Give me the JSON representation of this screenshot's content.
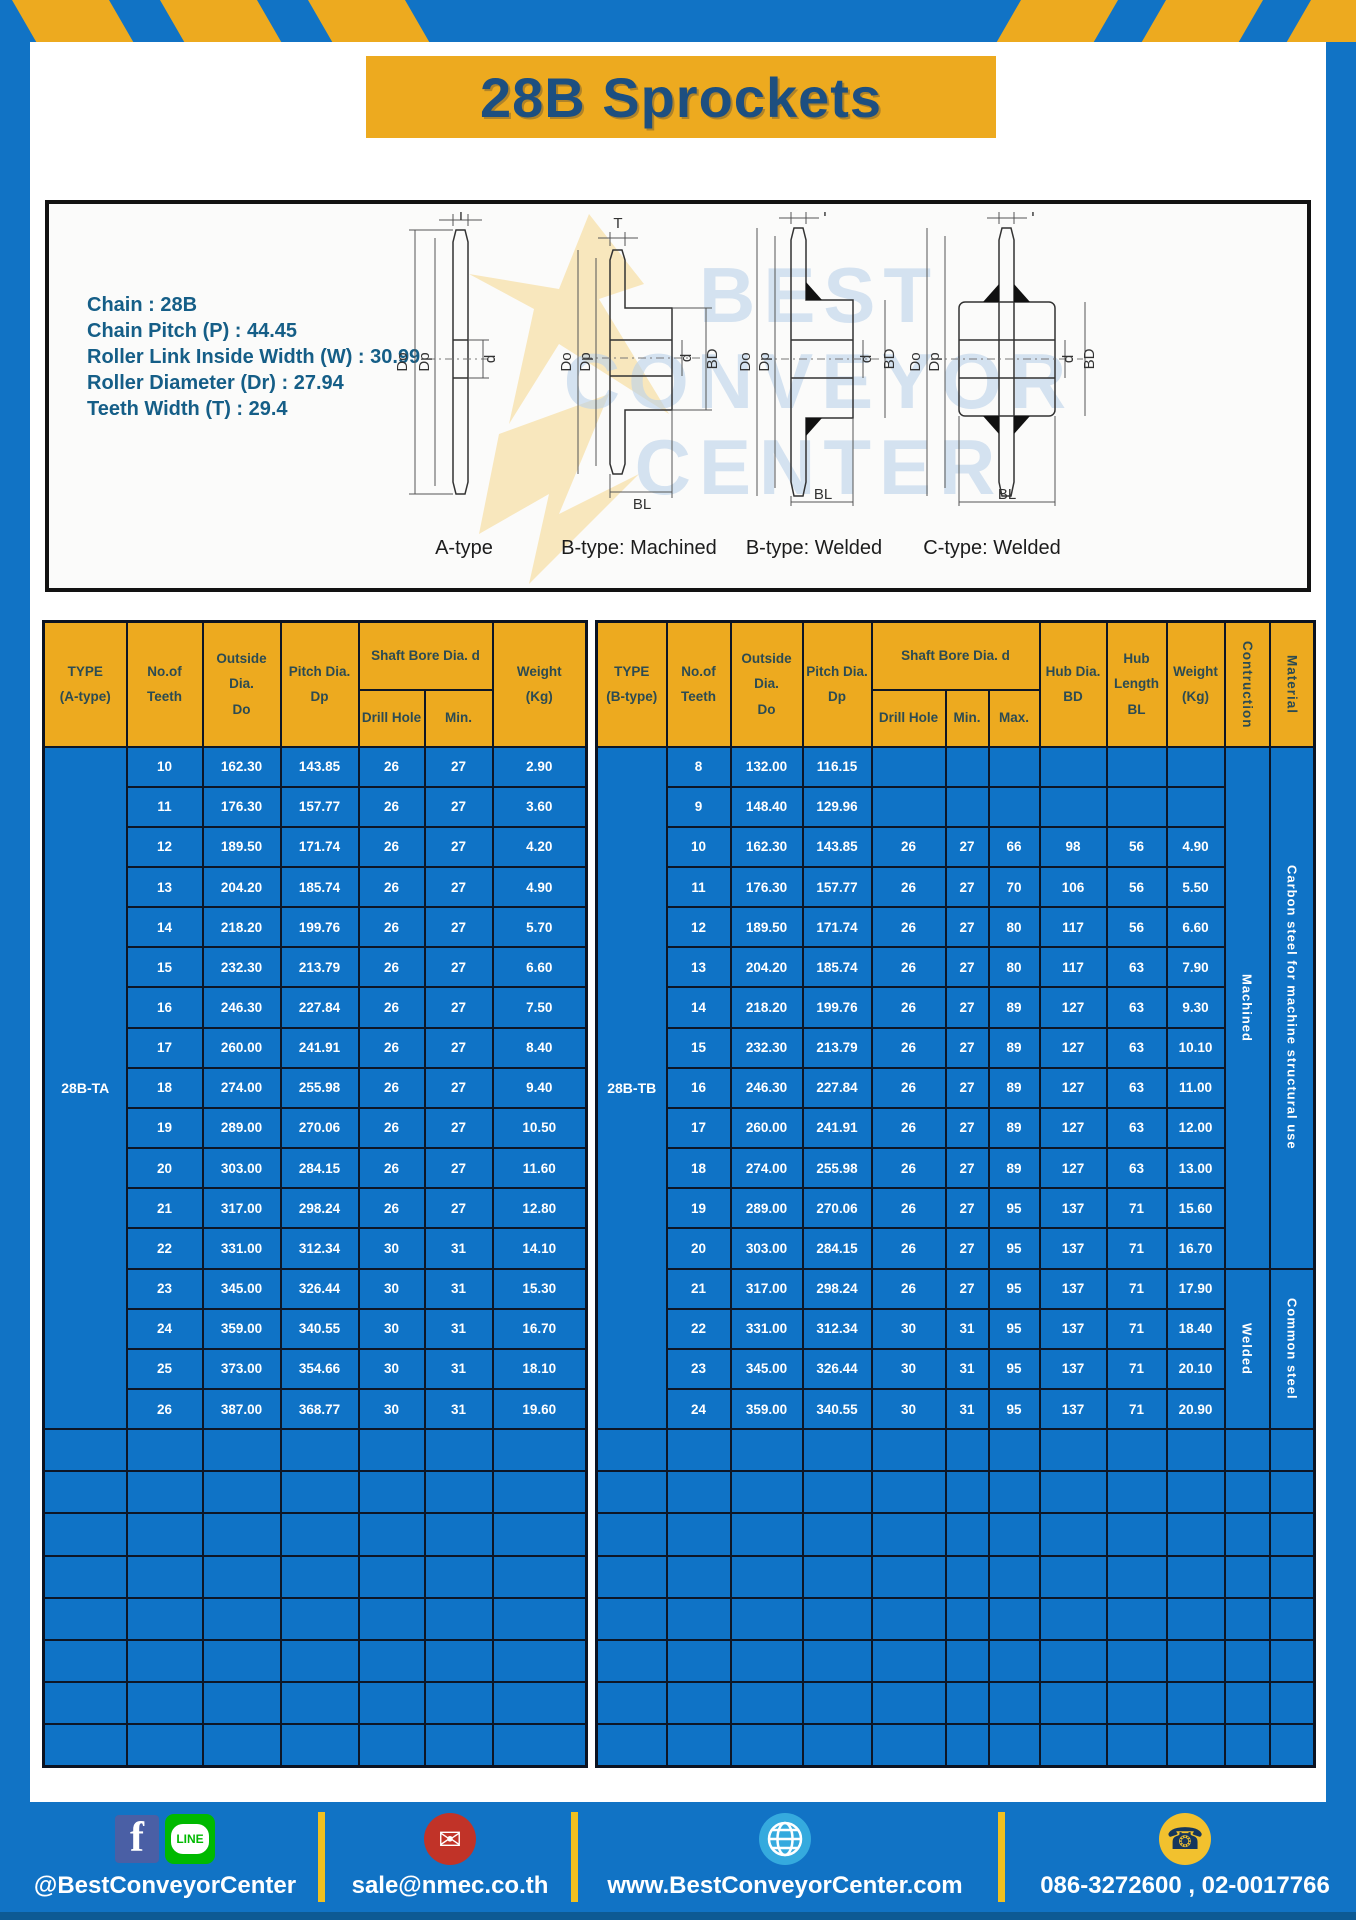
{
  "header": {
    "title": "28B Sprockets"
  },
  "specs": [
    "Chain  : 28B",
    "Chain Pitch (P)  : 44.45",
    "Roller Link Inside Width (W)  : 30.99",
    "Roller Diameter (Dr)  : 27.94",
    "Teeth Width (T)  : 29.4"
  ],
  "watermark": {
    "lines": [
      "BEST",
      "CONVEYOR",
      "CENTER"
    ]
  },
  "dims": {
    "t": "T",
    "doo": "Do",
    "dp": "Dp",
    "d": "d",
    "bd": "BD",
    "bl": "BL"
  },
  "diagrams": [
    {
      "caption": "A-type"
    },
    {
      "caption": "B-type: Machined"
    },
    {
      "caption": "B-type: Welded"
    },
    {
      "caption": "C-type: Welded"
    }
  ],
  "tableA": {
    "type": "28B-TA",
    "header": {
      "type": "TYPE\n(A-type)",
      "teeth": "No.of\nTeeth",
      "outside": "Outside\nDia.\nDo",
      "pitch": "Pitch Dia.\nDp",
      "shaft": "Shaft Bore Dia. d",
      "drill": "Drill Hole",
      "min": "Min.",
      "weight": "Weight\n(Kg)"
    },
    "rows": [
      {
        "teeth": "10",
        "do": "162.30",
        "dp": "143.85",
        "drill": "26",
        "min": "27",
        "weight": "2.90"
      },
      {
        "teeth": "11",
        "do": "176.30",
        "dp": "157.77",
        "drill": "26",
        "min": "27",
        "weight": "3.60"
      },
      {
        "teeth": "12",
        "do": "189.50",
        "dp": "171.74",
        "drill": "26",
        "min": "27",
        "weight": "4.20"
      },
      {
        "teeth": "13",
        "do": "204.20",
        "dp": "185.74",
        "drill": "26",
        "min": "27",
        "weight": "4.90"
      },
      {
        "teeth": "14",
        "do": "218.20",
        "dp": "199.76",
        "drill": "26",
        "min": "27",
        "weight": "5.70"
      },
      {
        "teeth": "15",
        "do": "232.30",
        "dp": "213.79",
        "drill": "26",
        "min": "27",
        "weight": "6.60"
      },
      {
        "teeth": "16",
        "do": "246.30",
        "dp": "227.84",
        "drill": "26",
        "min": "27",
        "weight": "7.50"
      },
      {
        "teeth": "17",
        "do": "260.00",
        "dp": "241.91",
        "drill": "26",
        "min": "27",
        "weight": "8.40"
      },
      {
        "teeth": "18",
        "do": "274.00",
        "dp": "255.98",
        "drill": "26",
        "min": "27",
        "weight": "9.40"
      },
      {
        "teeth": "19",
        "do": "289.00",
        "dp": "270.06",
        "drill": "26",
        "min": "27",
        "weight": "10.50"
      },
      {
        "teeth": "20",
        "do": "303.00",
        "dp": "284.15",
        "drill": "26",
        "min": "27",
        "weight": "11.60"
      },
      {
        "teeth": "21",
        "do": "317.00",
        "dp": "298.24",
        "drill": "26",
        "min": "27",
        "weight": "12.80"
      },
      {
        "teeth": "22",
        "do": "331.00",
        "dp": "312.34",
        "drill": "30",
        "min": "31",
        "weight": "14.10"
      },
      {
        "teeth": "23",
        "do": "345.00",
        "dp": "326.44",
        "drill": "30",
        "min": "31",
        "weight": "15.30"
      },
      {
        "teeth": "24",
        "do": "359.00",
        "dp": "340.55",
        "drill": "30",
        "min": "31",
        "weight": "16.70"
      },
      {
        "teeth": "25",
        "do": "373.00",
        "dp": "354.66",
        "drill": "30",
        "min": "31",
        "weight": "18.10"
      },
      {
        "teeth": "26",
        "do": "387.00",
        "dp": "368.77",
        "drill": "30",
        "min": "31",
        "weight": "19.60"
      }
    ]
  },
  "tableB": {
    "type": "28B-TB",
    "header": {
      "type": "TYPE\n(B-type)",
      "teeth": "No.of\nTeeth",
      "outside": "Outside\nDia.\nDo",
      "pitch": "Pitch Dia.\nDp",
      "shaft": "Shaft Bore Dia. d",
      "drill": "Drill Hole",
      "min": "Min.",
      "max": "Max.",
      "hubdia": "Hub Dia.\nBD",
      "hublen": "Hub\nLength\nBL",
      "weight": "Weight\n(Kg)",
      "construction": "Contruction",
      "material": "Material"
    },
    "rows": [
      {
        "teeth": "8",
        "do": "132.00",
        "dp": "116.15",
        "drill": "",
        "min": "",
        "max": "",
        "bd": "",
        "bl": "",
        "weight": ""
      },
      {
        "teeth": "9",
        "do": "148.40",
        "dp": "129.96",
        "drill": "",
        "min": "",
        "max": "",
        "bd": "",
        "bl": "",
        "weight": ""
      },
      {
        "teeth": "10",
        "do": "162.30",
        "dp": "143.85",
        "drill": "26",
        "min": "27",
        "max": "66",
        "bd": "98",
        "bl": "56",
        "weight": "4.90"
      },
      {
        "teeth": "11",
        "do": "176.30",
        "dp": "157.77",
        "drill": "26",
        "min": "27",
        "max": "70",
        "bd": "106",
        "bl": "56",
        "weight": "5.50"
      },
      {
        "teeth": "12",
        "do": "189.50",
        "dp": "171.74",
        "drill": "26",
        "min": "27",
        "max": "80",
        "bd": "117",
        "bl": "56",
        "weight": "6.60"
      },
      {
        "teeth": "13",
        "do": "204.20",
        "dp": "185.74",
        "drill": "26",
        "min": "27",
        "max": "80",
        "bd": "117",
        "bl": "63",
        "weight": "7.90"
      },
      {
        "teeth": "14",
        "do": "218.20",
        "dp": "199.76",
        "drill": "26",
        "min": "27",
        "max": "89",
        "bd": "127",
        "bl": "63",
        "weight": "9.30"
      },
      {
        "teeth": "15",
        "do": "232.30",
        "dp": "213.79",
        "drill": "26",
        "min": "27",
        "max": "89",
        "bd": "127",
        "bl": "63",
        "weight": "10.10"
      },
      {
        "teeth": "16",
        "do": "246.30",
        "dp": "227.84",
        "drill": "26",
        "min": "27",
        "max": "89",
        "bd": "127",
        "bl": "63",
        "weight": "11.00"
      },
      {
        "teeth": "17",
        "do": "260.00",
        "dp": "241.91",
        "drill": "26",
        "min": "27",
        "max": "89",
        "bd": "127",
        "bl": "63",
        "weight": "12.00"
      },
      {
        "teeth": "18",
        "do": "274.00",
        "dp": "255.98",
        "drill": "26",
        "min": "27",
        "max": "89",
        "bd": "127",
        "bl": "63",
        "weight": "13.00"
      },
      {
        "teeth": "19",
        "do": "289.00",
        "dp": "270.06",
        "drill": "26",
        "min": "27",
        "max": "95",
        "bd": "137",
        "bl": "71",
        "weight": "15.60"
      },
      {
        "teeth": "20",
        "do": "303.00",
        "dp": "284.15",
        "drill": "26",
        "min": "27",
        "max": "95",
        "bd": "137",
        "bl": "71",
        "weight": "16.70"
      },
      {
        "teeth": "21",
        "do": "317.00",
        "dp": "298.24",
        "drill": "26",
        "min": "27",
        "max": "95",
        "bd": "137",
        "bl": "71",
        "weight": "17.90"
      },
      {
        "teeth": "22",
        "do": "331.00",
        "dp": "312.34",
        "drill": "30",
        "min": "31",
        "max": "95",
        "bd": "137",
        "bl": "71",
        "weight": "18.40"
      },
      {
        "teeth": "23",
        "do": "345.00",
        "dp": "326.44",
        "drill": "30",
        "min": "31",
        "max": "95",
        "bd": "137",
        "bl": "71",
        "weight": "20.10"
      },
      {
        "teeth": "24",
        "do": "359.00",
        "dp": "340.55",
        "drill": "30",
        "min": "31",
        "max": "95",
        "bd": "137",
        "bl": "71",
        "weight": "20.90"
      }
    ],
    "construction_groups": [
      {
        "label": "Machined",
        "start": 0,
        "span": 13
      },
      {
        "label": "Welded",
        "start": 13,
        "span": 4
      }
    ],
    "material_groups": [
      {
        "label": "Carbon steel for  machine structural use",
        "start": 0,
        "span": 13
      },
      {
        "label": "Common steel",
        "start": 13,
        "span": 4
      }
    ]
  },
  "footer": {
    "items": [
      {
        "label": "@BestConveyorCenter"
      },
      {
        "label": "sale@nmec.co.th"
      },
      {
        "label": "www.BestConveyorCenter.com"
      },
      {
        "label": "086-3272600 , 02-0017766"
      }
    ],
    "line_icon_text": "LINE",
    "fb_icon_text": "f"
  },
  "colors": {
    "page_blue": "#1173c5",
    "table_blue": "#0f73c6",
    "header_yellow": "#edaa1f",
    "title_blue": "#1d4f80",
    "header_text": "#2c4b52",
    "border_dark": "#0d1626"
  }
}
